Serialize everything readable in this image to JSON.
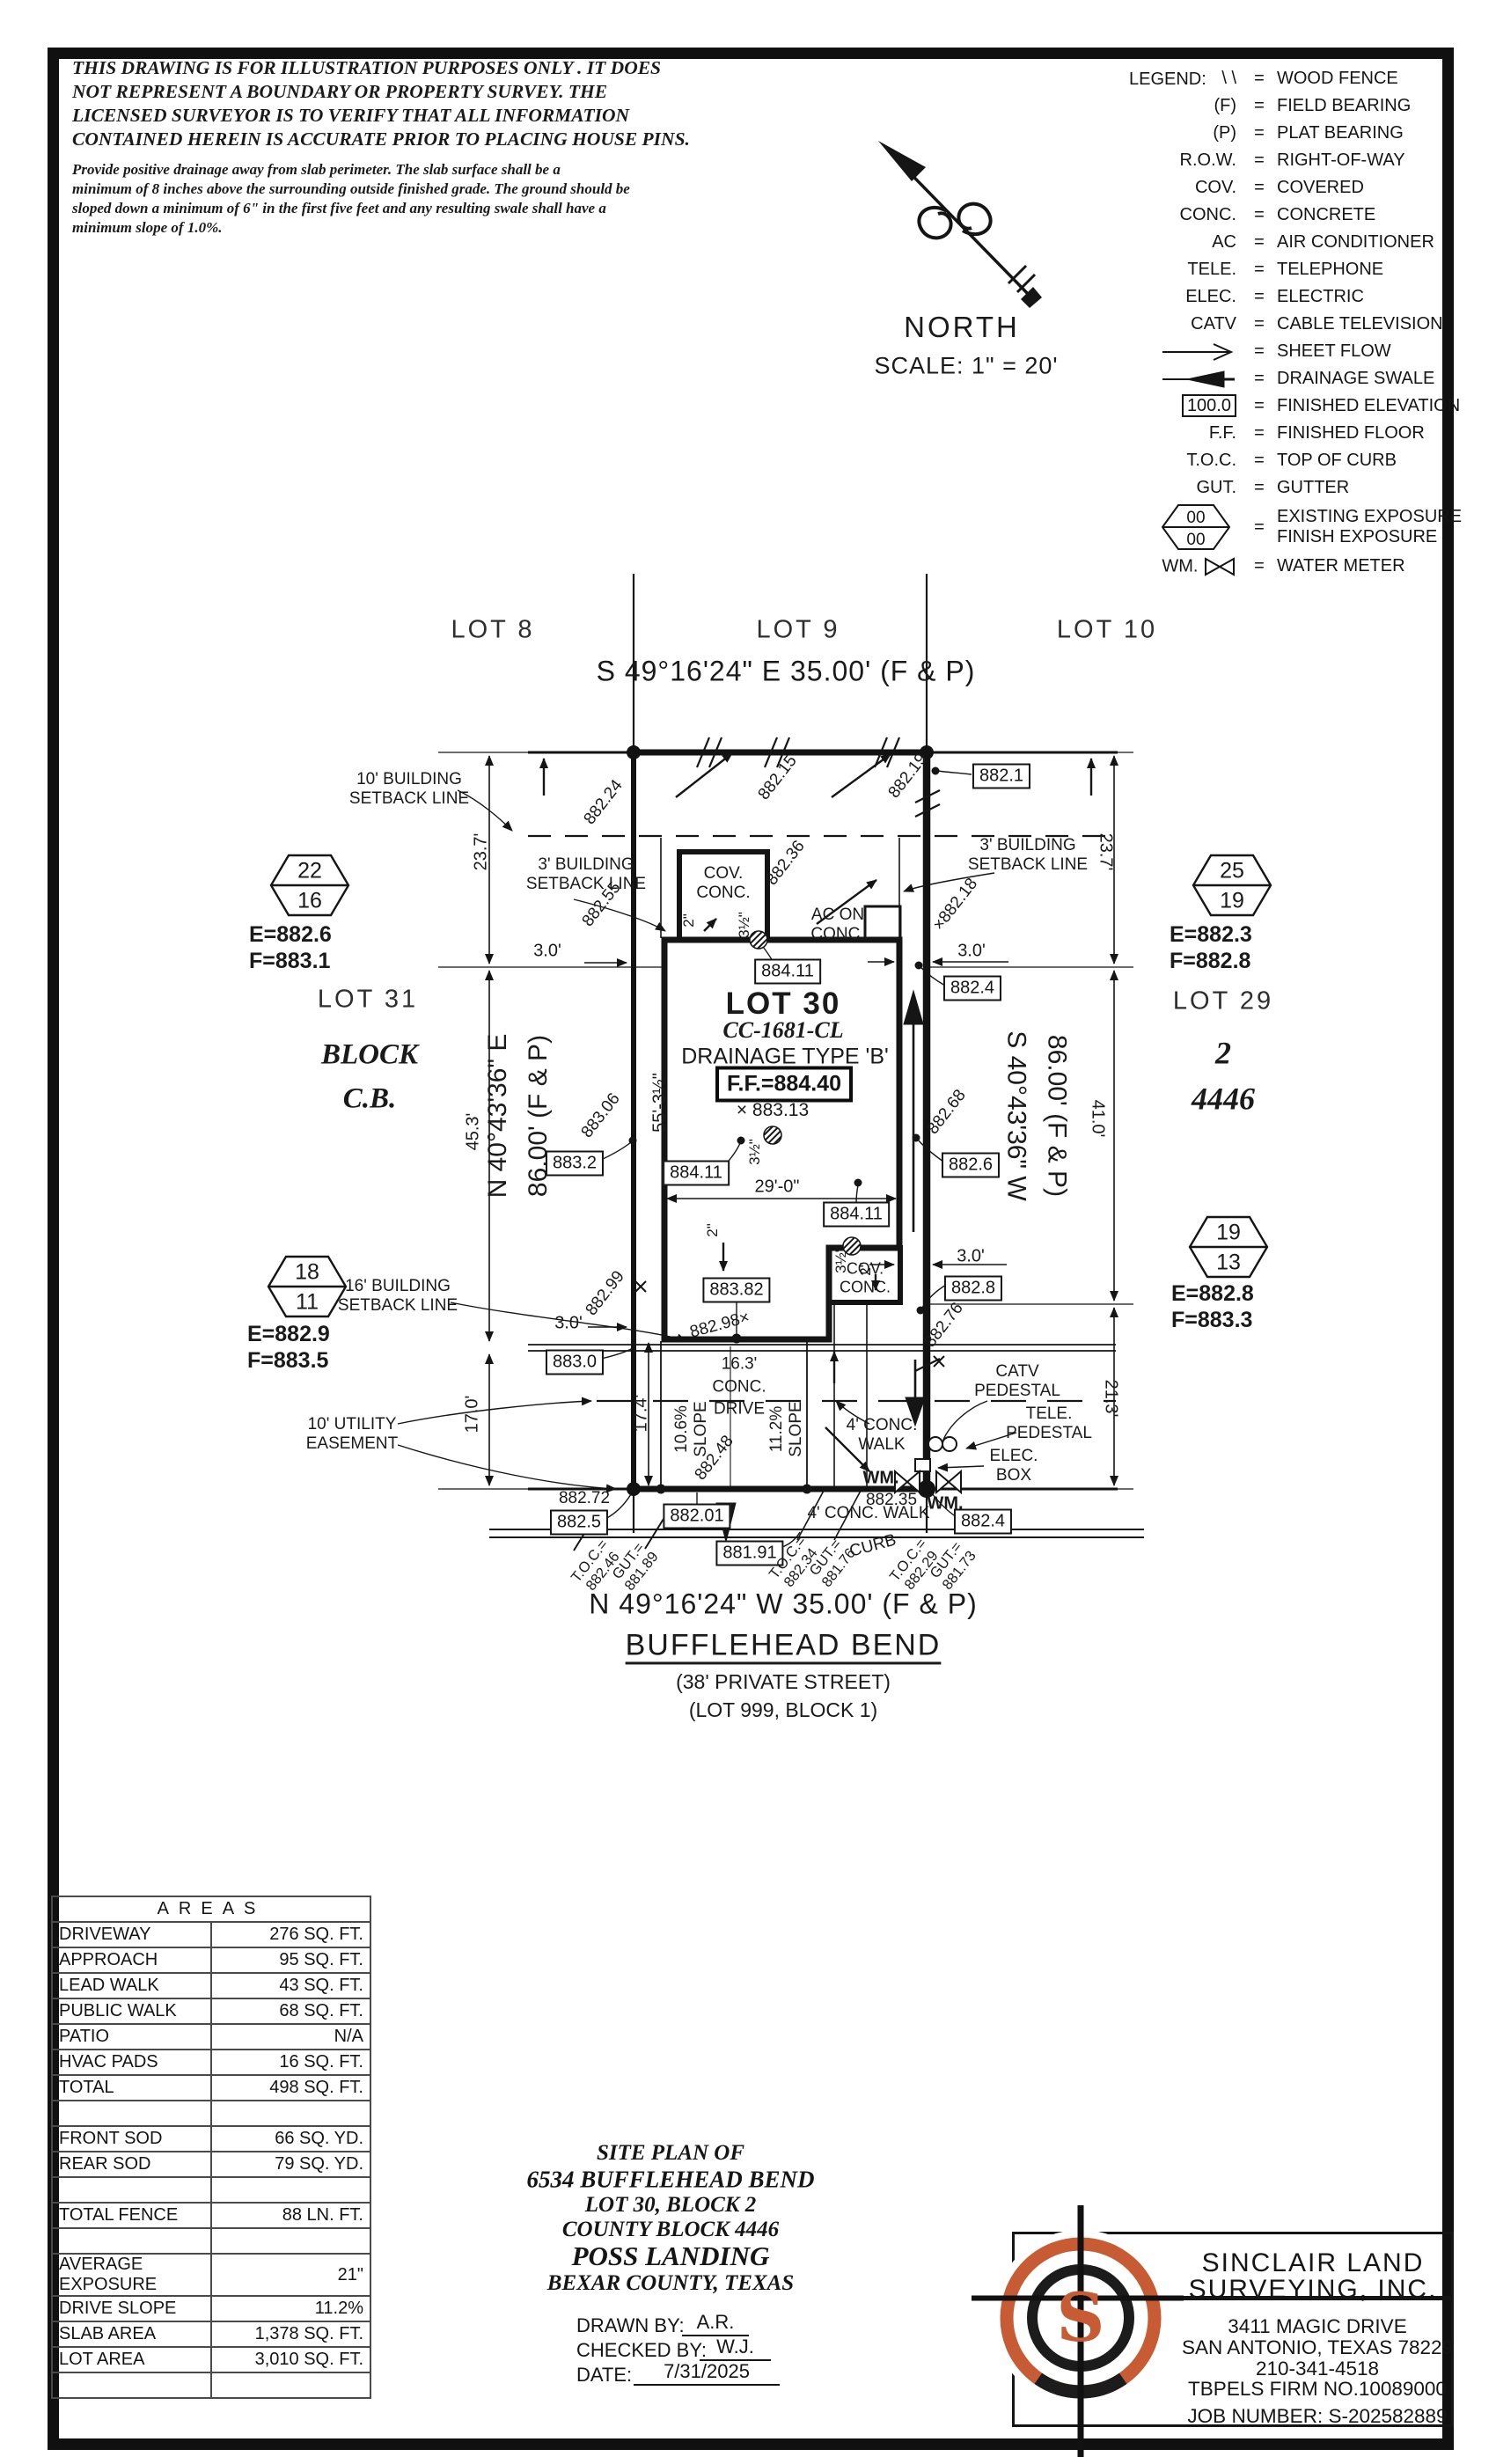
{
  "colors": {
    "ink": "#151515",
    "accent": "#c75b33"
  },
  "disclaimer": {
    "para1": "THIS DRAWING IS FOR ILLUSTRATION PURPOSES ONLY . IT DOES\nNOT REPRESENT A BOUNDARY OR PROPERTY SURVEY. THE\nLICENSED SURVEYOR IS TO VERIFY THAT ALL INFORMATION\nCONTAINED HEREIN IS ACCURATE PRIOR TO PLACING HOUSE PINS.",
    "para2": "Provide positive drainage away from slab perimeter. The slab surface shall be a\nminimum of 8 inches above the surrounding outside finished grade. The ground should be\nsloped down a minimum of 6\" in the first five feet and any resulting swale shall have a\nminimum slope of 1.0%."
  },
  "north": {
    "label": "NORTH",
    "scale": "SCALE: 1\" = 20'"
  },
  "legend": {
    "title": "LEGEND:",
    "items": [
      {
        "symbol": "\\ \\",
        "label": "WOOD FENCE"
      },
      {
        "symbol": "(F)",
        "label": "FIELD BEARING"
      },
      {
        "symbol": "(P)",
        "label": "PLAT BEARING"
      },
      {
        "symbol": "R.O.W.",
        "label": "RIGHT-OF-WAY"
      },
      {
        "symbol": "COV.",
        "label": "COVERED"
      },
      {
        "symbol": "CONC.",
        "label": "CONCRETE"
      },
      {
        "symbol": "AC",
        "label": "AIR CONDITIONER"
      },
      {
        "symbol": "TELE.",
        "label": "TELEPHONE"
      },
      {
        "symbol": "ELEC.",
        "label": "ELECTRIC"
      },
      {
        "symbol": "CATV",
        "label": "CABLE TELEVISION"
      },
      {
        "symbol_icon": "sheet-flow-arrow",
        "label": "SHEET FLOW"
      },
      {
        "symbol_icon": "drainage-swale-arrow",
        "label": "DRAINAGE SWALE"
      },
      {
        "symbol": "100.0",
        "label": "FINISHED ELEVATION"
      },
      {
        "symbol": "F.F.",
        "label": "FINISHED FLOOR"
      },
      {
        "symbol": "T.O.C.",
        "label": "TOP OF CURB"
      },
      {
        "symbol": "GUT.",
        "label": "GUTTER"
      },
      {
        "symbol_icon": "exposure-hexagon",
        "exposure_top": "00",
        "exposure_bottom": "00",
        "label": "EXISTING EXPOSURE\nFINISH EXPOSURE"
      },
      {
        "symbol": "WM.",
        "symbol_icon": "water-meter-bowtie",
        "label": "WATER METER"
      }
    ]
  },
  "plan": {
    "labels": {
      "lot8": "LOT 8",
      "lot9": "LOT 9",
      "lot10": "LOT 10",
      "bearing_top": "S 49°16'24\" E 35.00' (F & P)",
      "bearing_bottom": "N 49°16'24\" W 35.00' (F & P)",
      "street_name": "BUFFLEHEAD BEND",
      "street_private": "(38' PRIVATE STREET)",
      "street_lot": "(LOT 999, BLOCK 1)",
      "lot30": "LOT 30",
      "cc": "CC-1681-CL",
      "drainage": "DRAINAGE TYPE 'B'",
      "ff": "F.F.=884.40",
      "x883_13": "× 883.13",
      "lot31": "LOT 31",
      "block_cb": "BLOCK\nC.B.",
      "lot29": "LOT 29",
      "block2": "2",
      "cb4446": "4446",
      "bearing_left": "N 40°43'36\" E",
      "len_left": "86.00' (F & P)",
      "bearing_right": "S 40°43'36\" W",
      "len_right": "86.00' (F & P)",
      "setback10": "10' BUILDING\nSETBACK LINE",
      "setback3_left": "3' BUILDING\nSETBACK LINE",
      "setback3_right": "3' BUILDING\nSETBACK LINE",
      "setback16": "16' BUILDING\nSETBACK LINE",
      "easement10": "10' UTILITY\nEASEMENT",
      "cov_conc_front": "COV.\nCONC.",
      "cov_conc_rear": "COV.\nCONC.",
      "ac_conc": "AC ON\nCONC.",
      "drive": "16.3'\nCONC.\nDRIVE",
      "slope1": "10.6%\nSLOPE",
      "slope2": "11.2%\nSLOPE",
      "walk_upper": "4' CONC.\nWALK",
      "walk_lower": "4' CONC. WALK",
      "catv": "CATV\nPEDESTAL",
      "tele": "TELE.\nPEDESTAL",
      "elec": "ELEC.\nBOX",
      "wm1": "WM.",
      "wm2": "WM.",
      "curb": "CURB",
      "d23_7a": "23.7'",
      "d23_7b": "23.7'",
      "d45_3": "45.3'",
      "d41_0": "41.0'",
      "d17_0": "17.0'",
      "d21_3": "21.3'",
      "d17_4": "17.4'",
      "d55": "55'-3½\"",
      "d29": "29'-0\"",
      "d3a": "3.0'",
      "d3b": "3.0'",
      "d3c": "3.0'",
      "d3d": "3.0'",
      "d2a": "2\"",
      "d2b": "2\"",
      "d2c": "2\"",
      "d35a": "3½\"",
      "d35b": "3½\"",
      "d35c": "3½\"",
      "b882_1": "882.1",
      "b884_11a": "884.11",
      "b882_4a": "882.4",
      "b883_2": "883.2",
      "b884_11b": "884.11",
      "b884_11c": "884.11",
      "b882_6": "882.6",
      "b883_82": "883.82",
      "b882_8": "882.8",
      "b883_0": "883.0",
      "b882_5": "882.5",
      "b882_01": "882.01",
      "b881_91": "881.91",
      "b882_4b": "882.4",
      "s882_24": "882.24",
      "s882_15": "882.15",
      "s882_19": "882.19",
      "s882_55": "882.55",
      "s882_36": "882.36",
      "s882_18": "×882.18",
      "s883_06": "883.06",
      "s882_68": "882.68",
      "s882_48": "882.48",
      "s882_99": "882.99",
      "s882_76": "882.76",
      "s882_98": "882.98×",
      "s882_72": "882.72",
      "s882_35": "882.35",
      "toc1": "T.O.C.=\n882.46",
      "gut1": "GUT.=\n881.89",
      "toc2": "T.O.C.=\n882.34",
      "gut2": "GUT.=\n881.76",
      "toc3": "T.O.C.=\n882.29",
      "gut3": "GUT.=\n881.73"
    },
    "hexagons": [
      {
        "top": "22",
        "bottom": "16",
        "ef": "E=882.6\nF=883.1"
      },
      {
        "top": "25",
        "bottom": "19",
        "ef": "E=882.3\nF=882.8"
      },
      {
        "top": "18",
        "bottom": "11",
        "ef": "E=882.9\nF=883.5"
      },
      {
        "top": "19",
        "bottom": "13",
        "ef": "E=882.8\nF=883.3"
      }
    ]
  },
  "areas": {
    "title": "AREAS",
    "rows": [
      {
        "label": "DRIVEWAY",
        "value": "276 SQ. FT."
      },
      {
        "label": "APPROACH",
        "value": "95 SQ. FT."
      },
      {
        "label": "LEAD WALK",
        "value": "43 SQ. FT."
      },
      {
        "label": "PUBLIC WALK",
        "value": "68 SQ. FT."
      },
      {
        "label": "PATIO",
        "value": "N/A"
      },
      {
        "label": "HVAC PADS",
        "value": "16 SQ. FT."
      },
      {
        "label": "TOTAL",
        "value": "498 SQ. FT."
      },
      {
        "label": "",
        "value": ""
      },
      {
        "label": "FRONT SOD",
        "value": "66 SQ. YD."
      },
      {
        "label": "REAR SOD",
        "value": "79 SQ. YD."
      },
      {
        "label": "",
        "value": ""
      },
      {
        "label": "TOTAL FENCE",
        "value": "88 LN. FT."
      },
      {
        "label": "",
        "value": ""
      },
      {
        "label": "AVERAGE EXPOSURE",
        "value": "21\""
      },
      {
        "label": "DRIVE SLOPE",
        "value": "11.2%"
      },
      {
        "label": "SLAB AREA",
        "value": "1,378 SQ. FT."
      },
      {
        "label": "LOT AREA",
        "value": "3,010 SQ. FT."
      },
      {
        "label": "",
        "value": ""
      }
    ]
  },
  "titleblock": {
    "line1": "SITE PLAN OF",
    "line2": "6534 BUFFLEHEAD BEND",
    "line3": "LOT 30, BLOCK 2",
    "line4": "COUNTY BLOCK 4446",
    "line5": "POSS LANDING",
    "line6": "BEXAR COUNTY, TEXAS",
    "drawn_label": "DRAWN BY:",
    "drawn_value": "A.R.",
    "checked_label": "CHECKED BY:",
    "checked_value": "W.J.",
    "date_label": "DATE:",
    "date_value": "7/31/2025"
  },
  "company": {
    "logo_letter": "S",
    "name1": "SINCLAIR LAND",
    "name2": "SURVEYING, INC.",
    "address1": "3411 MAGIC DRIVE",
    "address2": "SAN ANTONIO, TEXAS 78229",
    "phone": "210-341-4518",
    "firm": "TBPELS FIRM NO.10089000",
    "job": "JOB NUMBER: S-202582889"
  }
}
